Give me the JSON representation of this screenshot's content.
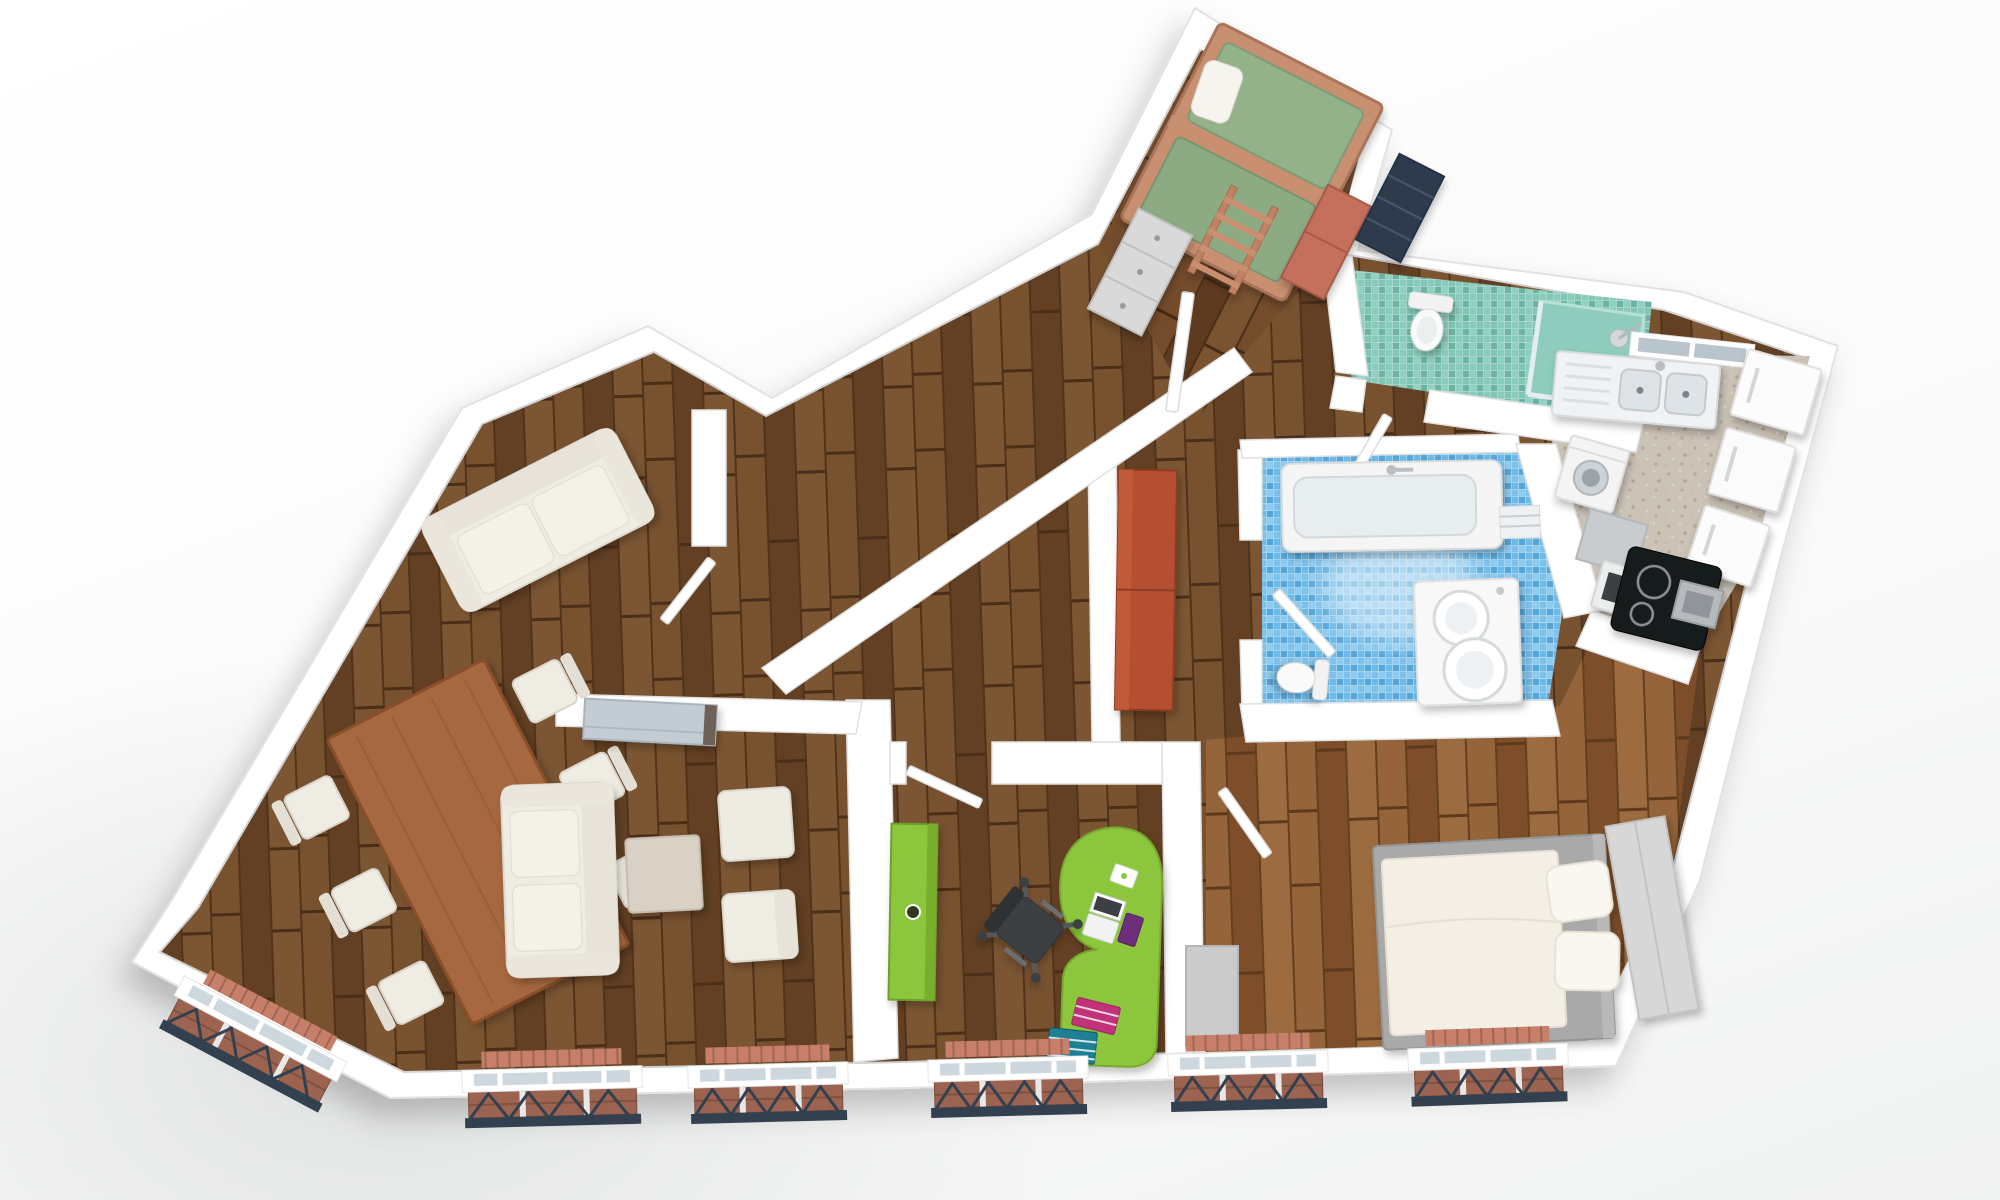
{
  "scene": {
    "label": "3D rendered top-down floor plan of an apartment with living-dining room, home office, children's room, bedroom, kitchen, bathroom and WC",
    "type": "floor-plan-3d-render"
  },
  "palette": {
    "background": "#f4f5f5",
    "wall": "#ffffff",
    "wall_edge": "#e2e2e2",
    "wood_dark": "#6e4a2b",
    "wood_gold": "#8a5a33",
    "kitchen_floor": "#ccc3b7",
    "teal_floor": "#79c0b0",
    "blue_floor": "#66b4e4",
    "accent_green": "#8bc63e",
    "red_wardrobe": "#b44f30",
    "radiator": "#c77f69",
    "railing": "#324050",
    "upholstery": "#efece4",
    "table_wood": "#a6683f",
    "bunk_wood": "#c89070",
    "mattress_green": "#93b28a",
    "appliance_dark": "#191a1c",
    "glass": "#cdd8de"
  },
  "rooms": [
    {
      "id": "living-dining-room",
      "floor": "dark-wood",
      "furniture": [
        "dining-table",
        "dining-chairs-x6",
        "large-sofa",
        "nook-sofa",
        "coffee-table",
        "ottoman",
        "armchair",
        "sideboard"
      ]
    },
    {
      "id": "home-office",
      "floor": "dark-wood",
      "furniture": [
        "green-wardrobe",
        "green-desk",
        "office-chair",
        "laptop",
        "book-stacks"
      ]
    },
    {
      "id": "hallway",
      "floor": "dark-wood",
      "furniture": [
        "red-wardrobe"
      ]
    },
    {
      "id": "children-room",
      "floor": "dark-wood",
      "furniture": [
        "bunk-bed",
        "ladder",
        "dresser",
        "salmon-wardrobe",
        "navy-cabinet"
      ]
    },
    {
      "id": "wc",
      "floor": "teal-mosaic",
      "furniture": [
        "toilet",
        "shower",
        "glass-partition"
      ]
    },
    {
      "id": "bathroom",
      "floor": "blue-mosaic",
      "furniture": [
        "bathtub",
        "double-sink-vanity",
        "toilet",
        "towel-rack"
      ]
    },
    {
      "id": "kitchen",
      "floor": "beige-tile",
      "furniture": [
        "double-sink",
        "kitchen-window",
        "washing-machine",
        "oven",
        "black-cooktop",
        "extractor-hood",
        "white-cabinets"
      ]
    },
    {
      "id": "bedroom",
      "floor": "golden-wood",
      "furniture": [
        "double-bed",
        "pillows-x2",
        "wardrobe",
        "closet"
      ]
    }
  ],
  "exterior": {
    "windows": 6,
    "features": [
      "radiators",
      "juliet-balconies",
      "angled-bay-window"
    ]
  }
}
